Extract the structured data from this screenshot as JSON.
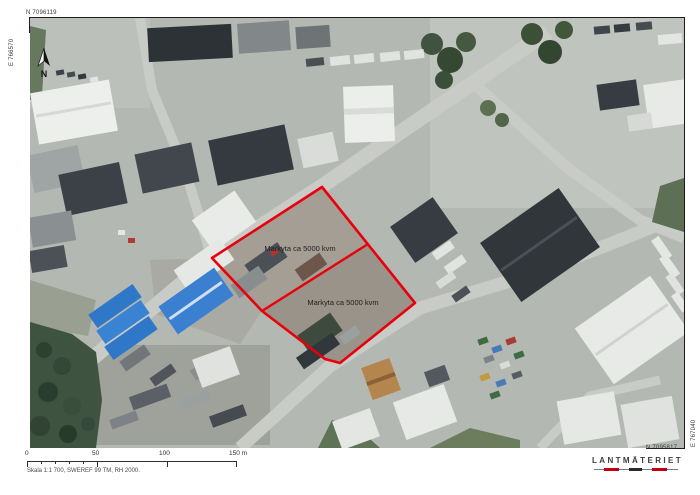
{
  "frame": {
    "coordinates": {
      "top_left_northing": "N 7096119",
      "left_easting": "E 766570",
      "right_easting": "E 767040",
      "bottom_right_northing": "N 7095817"
    },
    "north_label": "N",
    "scale_bar": {
      "labels": [
        "0",
        "50",
        "100",
        "150 m"
      ],
      "caption": "Skala 1:1 700, SWEREF 99 TM, RH 2000."
    },
    "logo_text": "LANTMÄTERIET"
  },
  "overlay": {
    "parcel_outline_points": "322,187 415,303 340,363 325,359 262,311 212,258",
    "divider_points": "368,244 262,311",
    "labels": [
      {
        "text": "Markyta ca 5000 kvm"
      },
      {
        "text": "Markyta ca 5000 kvm"
      }
    ],
    "boundary_color": "#e8000d"
  },
  "colors": {
    "boundary_red": "#e8000d",
    "logo_red": "#c00013",
    "logo_dark": "#2b2b2b",
    "asphalt": "#b4b8b2",
    "forest_green": "#3e5340",
    "dirt": "#a59e94"
  }
}
